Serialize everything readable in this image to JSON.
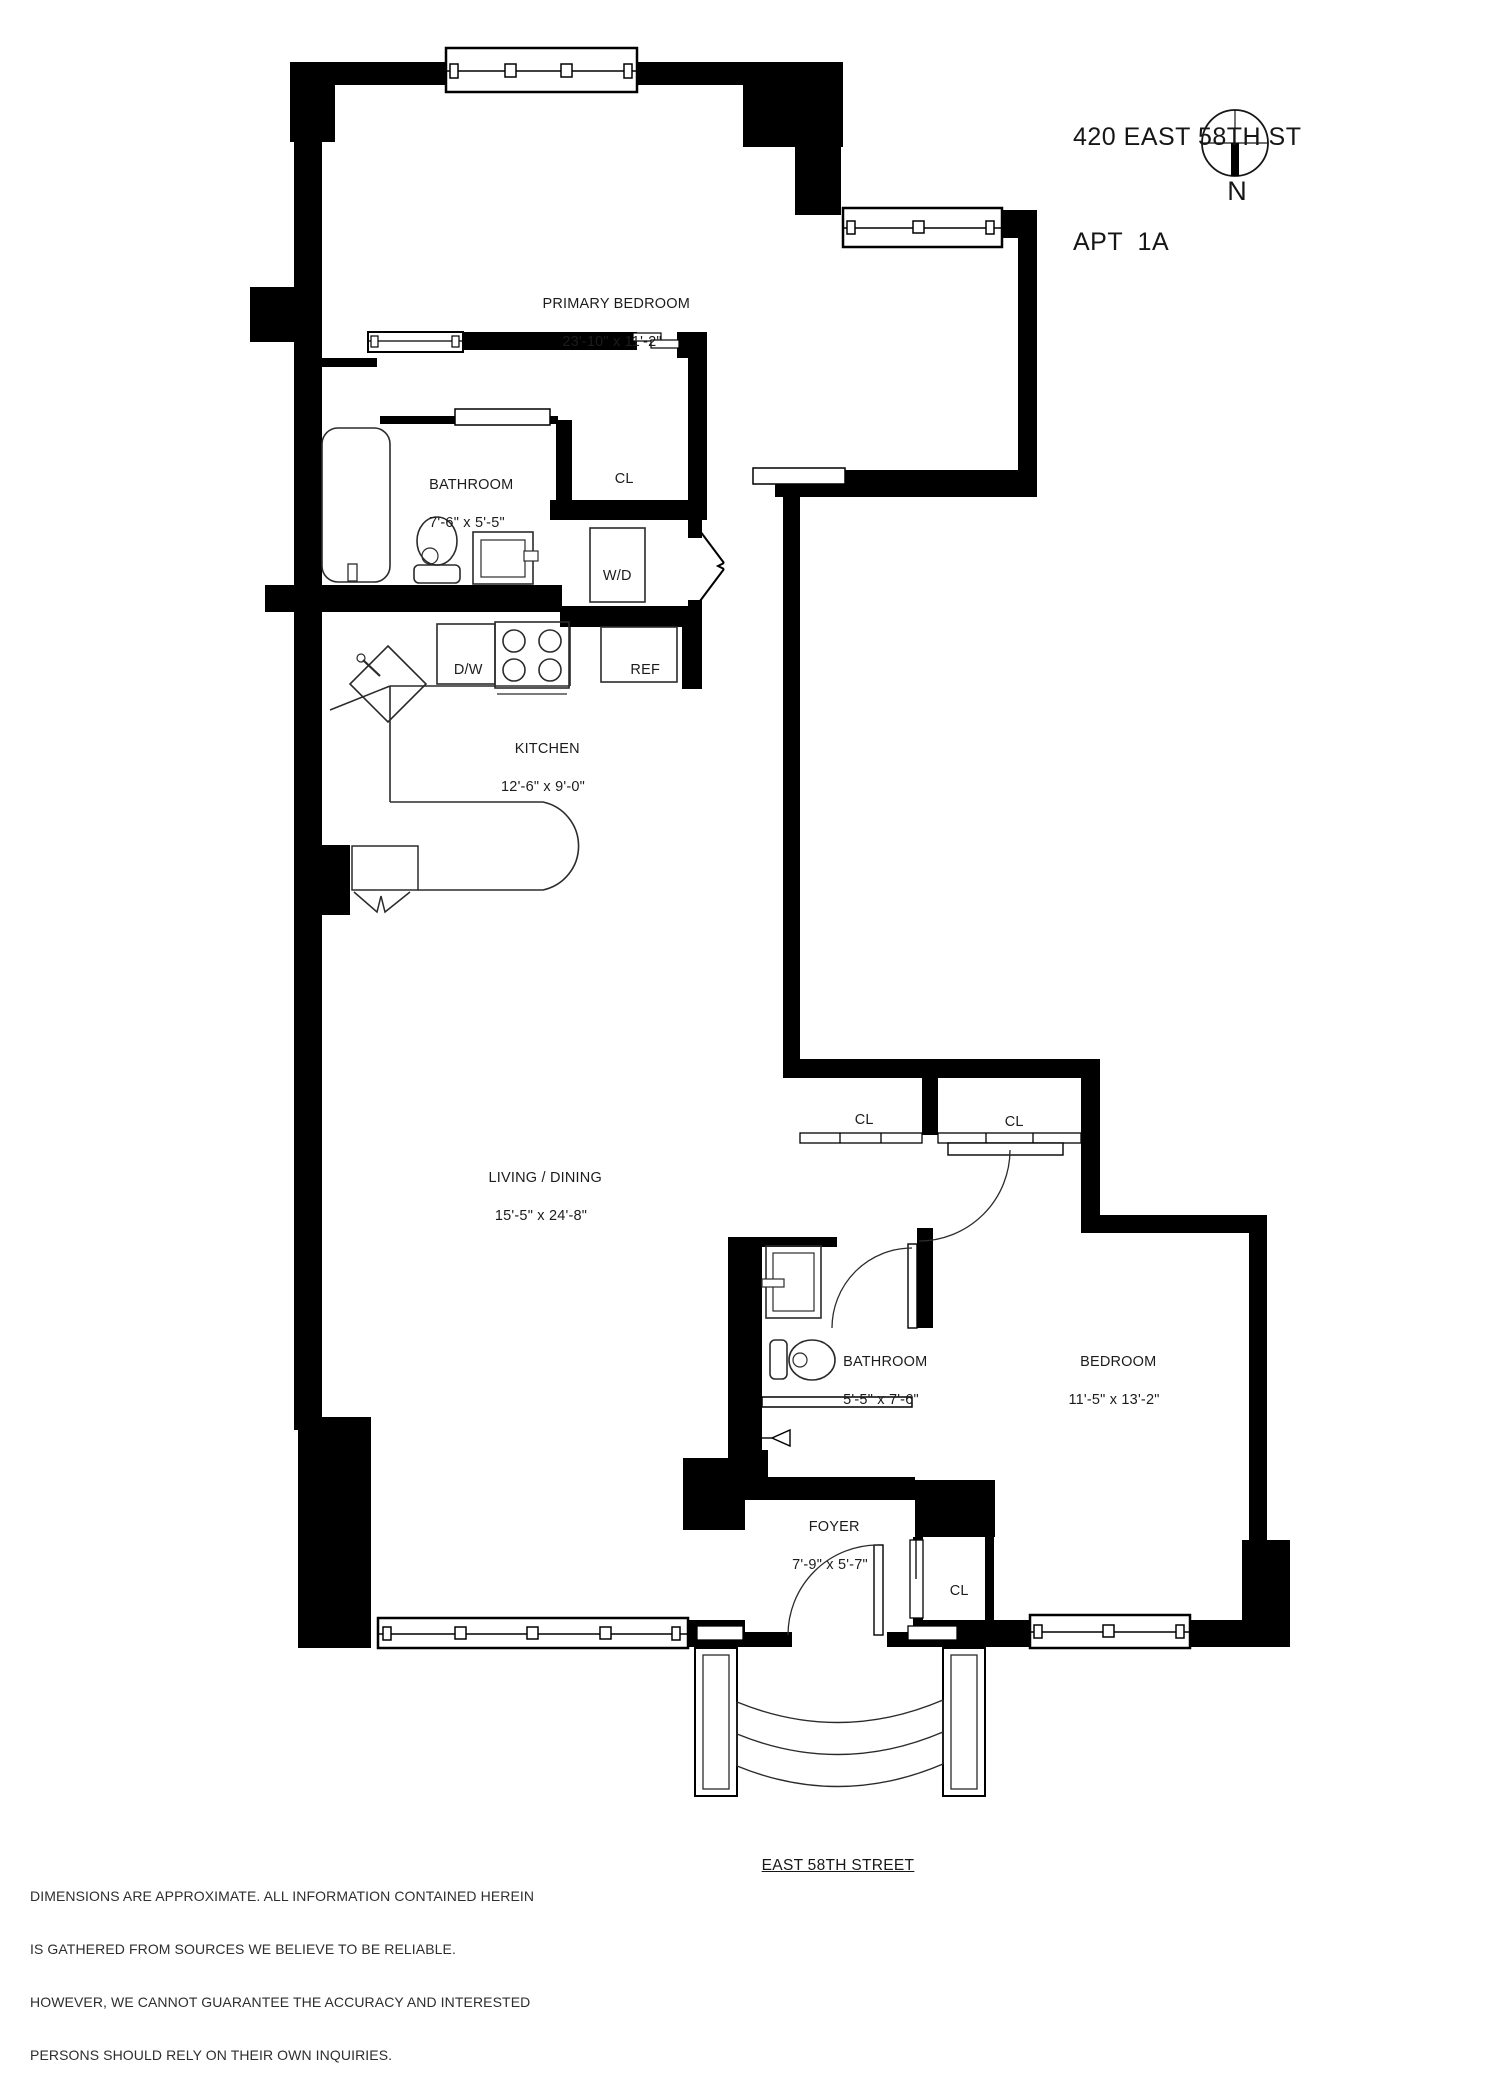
{
  "header": {
    "address_line1": "420 EAST 58TH ST",
    "address_line2": "APT  1A",
    "compass_label": "N"
  },
  "rooms": {
    "primary_bedroom": {
      "name": "PRIMARY BEDROOM",
      "dims": "23'-10\" x 11'-2\""
    },
    "bathroom1": {
      "name": "BATHROOM",
      "dims": "7'-6\" x 5'-5\""
    },
    "closet1": {
      "name": "CL"
    },
    "washer_dryer": {
      "name": "W/D"
    },
    "dishwasher": {
      "name": "D/W"
    },
    "refrigerator": {
      "name": "REF"
    },
    "kitchen": {
      "name": "KITCHEN",
      "dims": "12'-6\" x 9'-0\""
    },
    "living_dining": {
      "name": "LIVING / DINING",
      "dims": "15'-5\" x 24'-8\""
    },
    "closet2": {
      "name": "CL"
    },
    "closet3": {
      "name": "CL"
    },
    "bathroom2": {
      "name": "BATHROOM",
      "dims": "5'-5\" x 7'-6\""
    },
    "bedroom": {
      "name": "BEDROOM",
      "dims": "11'-5\" x 13'-2\""
    },
    "foyer": {
      "name": "FOYER",
      "dims": "7'-9\" x 5'-7\""
    },
    "closet4": {
      "name": "CL"
    }
  },
  "footer": {
    "street_label": "EAST 58TH STREET",
    "disclaimer_lines": [
      "DIMENSIONS ARE APPROXIMATE. ALL INFORMATION CONTAINED HEREIN",
      "IS GATHERED FROM SOURCES WE BELIEVE TO BE RELIABLE.",
      "HOWEVER, WE CANNOT GUARANTEE THE ACCURACY AND INTERESTED",
      "PERSONS SHOULD RELY ON THEIR OWN INQUIRIES."
    ]
  },
  "colors": {
    "wall": "#000000",
    "line": "#2b2b2b",
    "background": "#ffffff",
    "text": "#1c1c1c"
  }
}
